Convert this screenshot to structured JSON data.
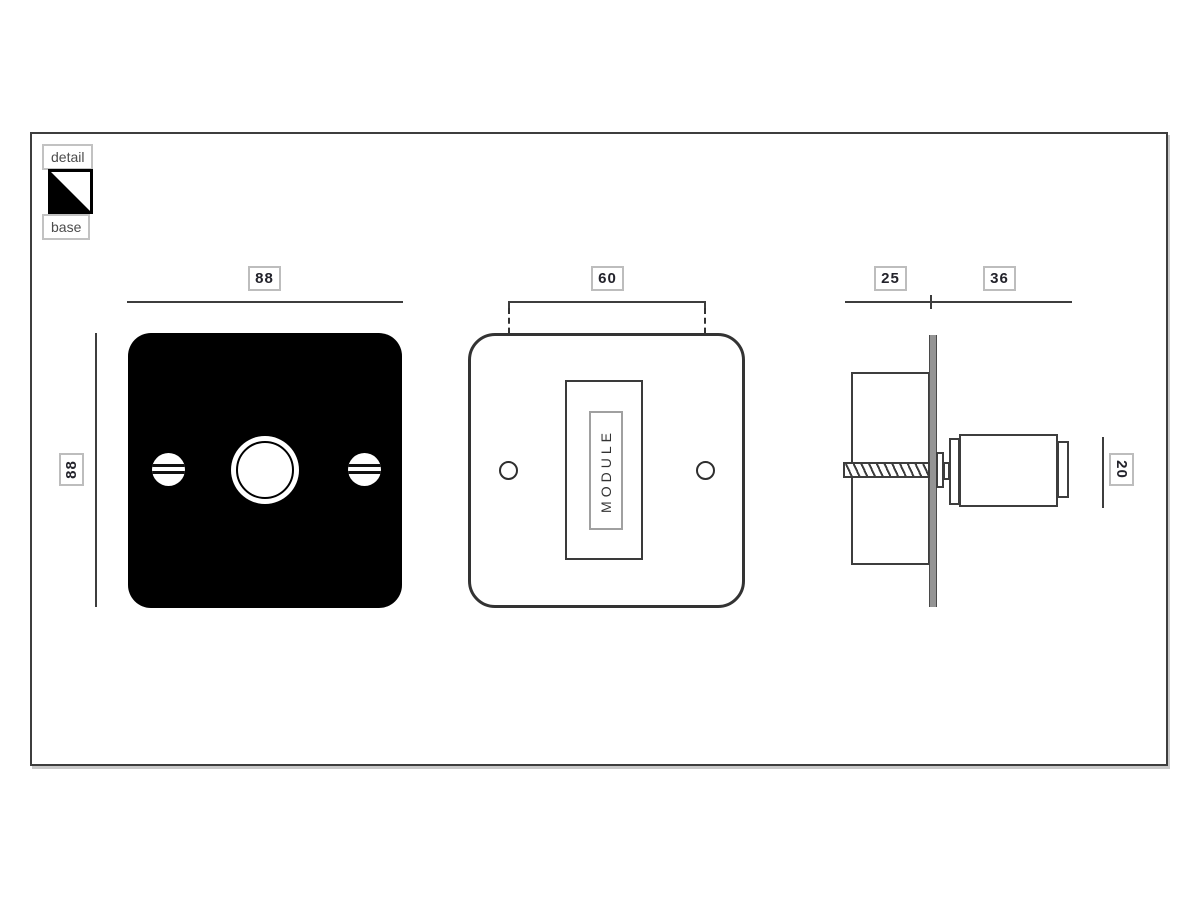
{
  "legend": {
    "detail": "detail",
    "base": "base",
    "icon": "diagonal-split-square"
  },
  "front_view": {
    "width": "88",
    "height": "88"
  },
  "base_view": {
    "hole_spacing": "60",
    "module": "MODULE"
  },
  "side_view": {
    "box_depth": "25",
    "knob_depth": "36",
    "knob_diameter": "20"
  },
  "colors": {
    "line": "#3d3d3d",
    "plate_black": "#000000",
    "label_border": "#bdbdbd",
    "label_text": "#23232b",
    "wall_plate_gray": "#949494",
    "background": "#ffffff"
  }
}
